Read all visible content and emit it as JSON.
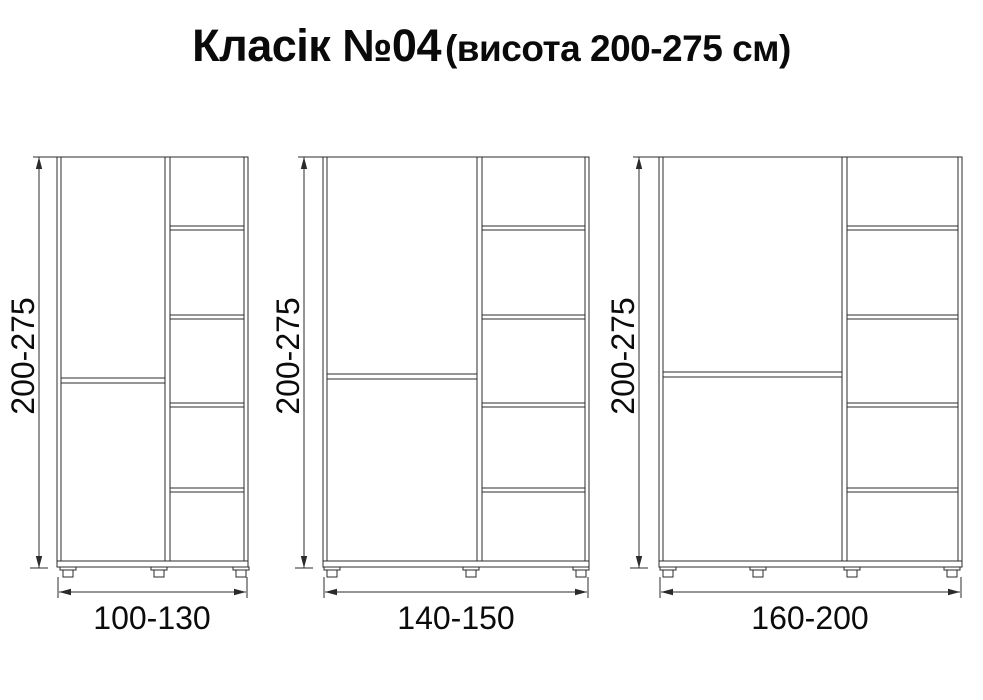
{
  "title": {
    "main": "Класік №04",
    "sub": "(висота 200-275 см)"
  },
  "colors": {
    "background": "#ffffff",
    "line": "#2b2b2b",
    "text": "#0b0b0b"
  },
  "cabinets": [
    {
      "height_label": "200-275",
      "width_label": "100-130",
      "shelf_compartments": 5,
      "door_sections": 2,
      "feet": 3
    },
    {
      "height_label": "200-275",
      "width_label": "140-150",
      "shelf_compartments": 5,
      "door_sections": 2,
      "feet": 3
    },
    {
      "height_label": "200-275",
      "width_label": "160-200",
      "shelf_compartments": 5,
      "door_sections": 2,
      "feet": 4
    }
  ]
}
